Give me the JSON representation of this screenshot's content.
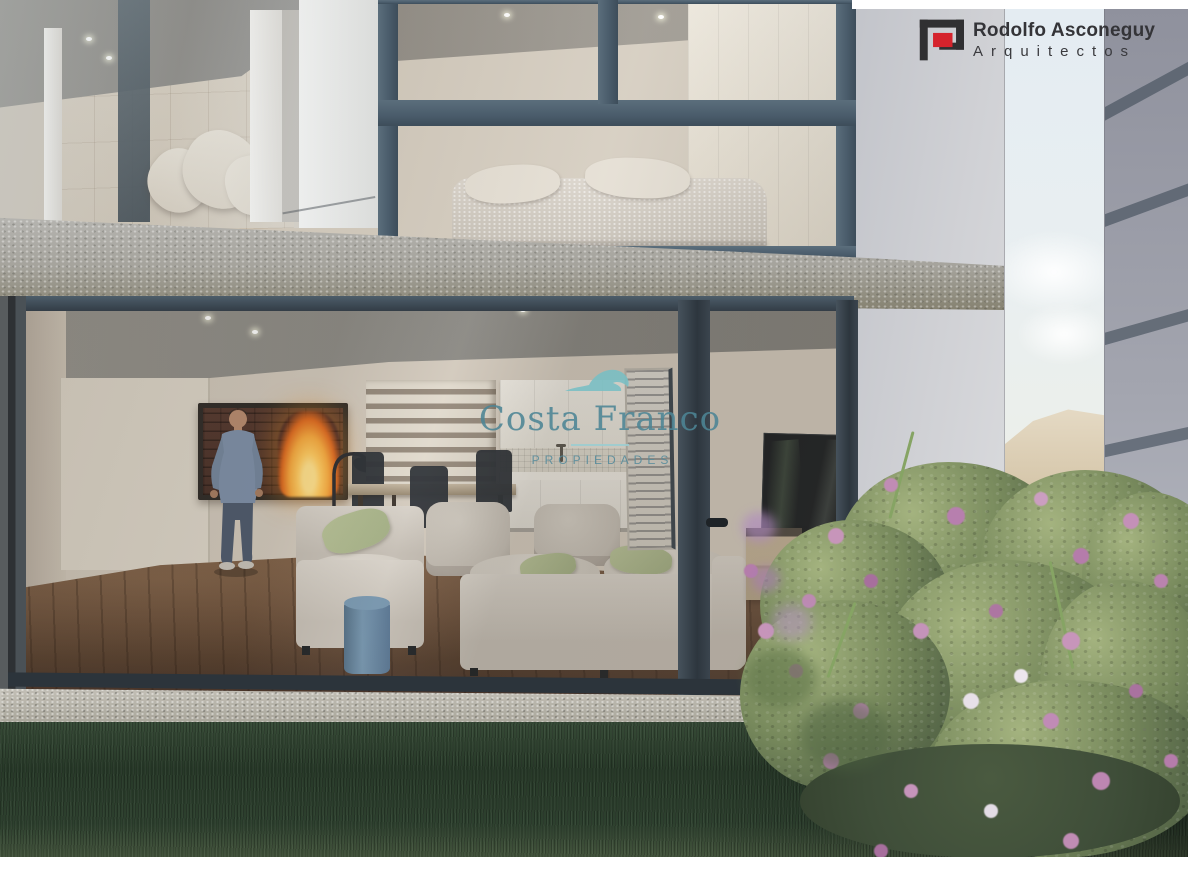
{
  "branding": {
    "architect_logo": {
      "line1": "Rodolfo Asconeguy",
      "line2": "Arquitectos",
      "icon": "architect-logo-icon"
    },
    "watermark": {
      "icon": "wave-icon",
      "name": "Costa Franco",
      "subtitle": "PROPIEDADES"
    }
  },
  "palette": {
    "logored": "#d5232c",
    "logodark": "#303032",
    "logotext": "#343438",
    "teal": "#4d8595",
    "tealight": "#79bfc4",
    "tealine": "#9ccdd1",
    "tealsub": "#558b9c",
    "frame": "#4a5c6b",
    "framedark": "#323c46",
    "wallgray": "#d0d1d5",
    "neighbor": "#9b9daa",
    "stripe": "#5b6470",
    "sky": "#e9f0f4",
    "sand": "#ddd0ba",
    "concrete": "#a8a7a2",
    "curb": "#b4b1a7",
    "interior": "#d3cabd",
    "ceiling": "#8e8c87",
    "wood": "#6b5242",
    "grass": "#2e4130",
    "bush": "#77895c",
    "bushdark": "#49593f",
    "bushlight": "#a4b37f",
    "flower": "#c495b8",
    "sofa": "#c9c2b8",
    "pillowgreen": "#adb98d",
    "stool": "#5d7489",
    "fire": "#f7a93e",
    "firecore": "#ffdf8a",
    "shirt": "#7e90a9",
    "jeans": "#4d596d"
  }
}
